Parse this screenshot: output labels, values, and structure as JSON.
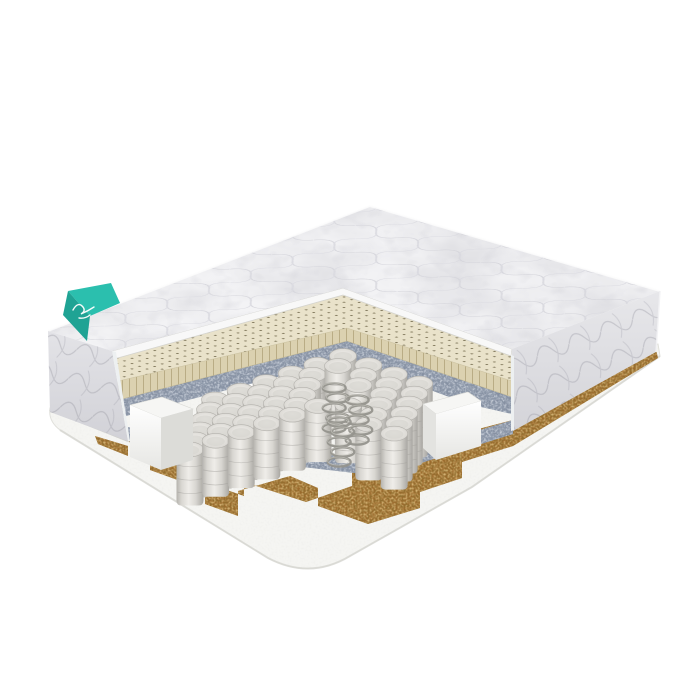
{
  "meta": {
    "description": "Product photo: double mattress shown in perspective with a front-corner cutaway exposing internal layers",
    "background": "#ffffff"
  },
  "colors": {
    "background": "#ffffff",
    "cover_white": "#f4f4f6",
    "cover_face": "#f8f8f8",
    "side_panel_left": "#e4e4e8",
    "side_panel_right": "#e8e8eb",
    "panel_cut_face": "#edf0f1",
    "latex_cream": "#e9e2ca",
    "latex_face": "#dbd1b0",
    "felt_gray": "#8f9aab",
    "spring_fabric": "#dddbd6",
    "coil_metal": "#95938d",
    "coir_brown": "#9b6b2d",
    "base_foam": "#f5f5f2",
    "box_foam_top": "#f6f6f4",
    "shadow_line": "#a9a9a6",
    "accent_teal": "#2bbfae",
    "accent_teal_dark": "#1fa394"
  },
  "tag": {
    "kind": "brand-tag-ribbon",
    "logo_style": "illegible-white-script"
  },
  "layers": [
    {
      "name": "quilted-top-cover",
      "color": "#f4f4f6"
    },
    {
      "name": "perforated-latex-layer",
      "color": "#e9e2ca"
    },
    {
      "name": "felt-padding-layer",
      "color": "#8f9aab"
    },
    {
      "name": "pocket-spring-block",
      "color": "#dddbd6"
    },
    {
      "name": "exposed-steel-coils",
      "color": "#95938d"
    },
    {
      "name": "foam-edge-supports",
      "color": "#f6f6f4"
    },
    {
      "name": "coconut-coir-layer",
      "color": "#9b6b2d"
    },
    {
      "name": "foam-base-layer",
      "color": "#f5f5f2"
    }
  ],
  "springs": {
    "vertex": [
      343,
      356
    ],
    "row_step": [
      -5,
      10
    ],
    "rows": 6,
    "left_step": [
      -25.6,
      8.7
    ],
    "left_count": 5,
    "right_step": [
      25.4,
      9.2
    ],
    "right_count": 3,
    "width": 27,
    "height": 66,
    "height_step": -2,
    "skip_vertex_rows": [
      2,
      3,
      4
    ],
    "skip_right1_rows": [
      3,
      5
    ]
  },
  "coils": {
    "positions": [
      [
        336,
        388
      ],
      [
        359,
        400
      ],
      [
        341,
        422
      ]
    ],
    "loops": 5,
    "rx": 11.5,
    "loop_gap": 10
  }
}
